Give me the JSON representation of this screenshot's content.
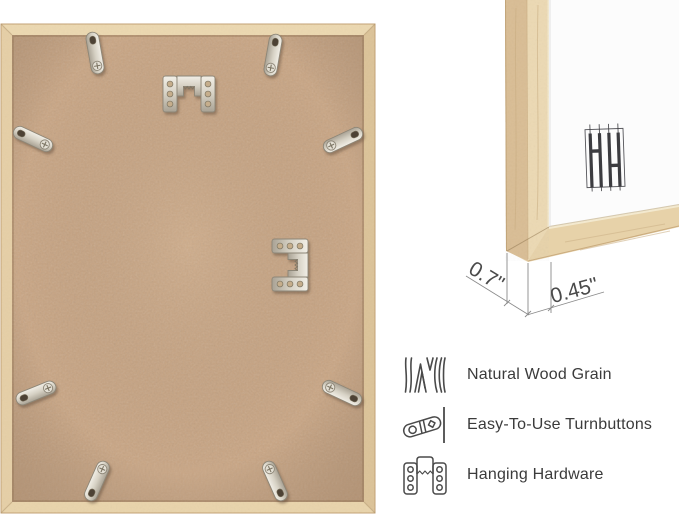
{
  "image_kind": "picture-frame product infographic",
  "back_view": {
    "description_icons": [
      "turnbutton-hardware",
      "sawtooth-hanger-hardware"
    ],
    "turnbutton_count": 8,
    "hanger_count": 2
  },
  "corner_view": {
    "depth_label": "0.7\"",
    "face_label": "0.45\"",
    "logo_icon": "hh-monogram-logo"
  },
  "features": [
    {
      "icon": "wood-grain-icon",
      "label": "Natural Wood Grain"
    },
    {
      "icon": "turnbutton-icon",
      "label": "Easy-To-Use Turnbuttons"
    },
    {
      "icon": "hanging-hardware-icon",
      "label": "Hanging Hardware"
    }
  ],
  "colors": {
    "background": "#ffffff",
    "wood_frame": "#e7d2a9",
    "wood_frame_side": "#d9bd94",
    "mdf_back": "#c9a583",
    "metal_hardware": "#d8d3c7",
    "mat_white": "#fcfcfc",
    "logo": "#3c3c40",
    "dimension_lines": "#8a8a8a",
    "feature_text": "#3b3b3b"
  }
}
